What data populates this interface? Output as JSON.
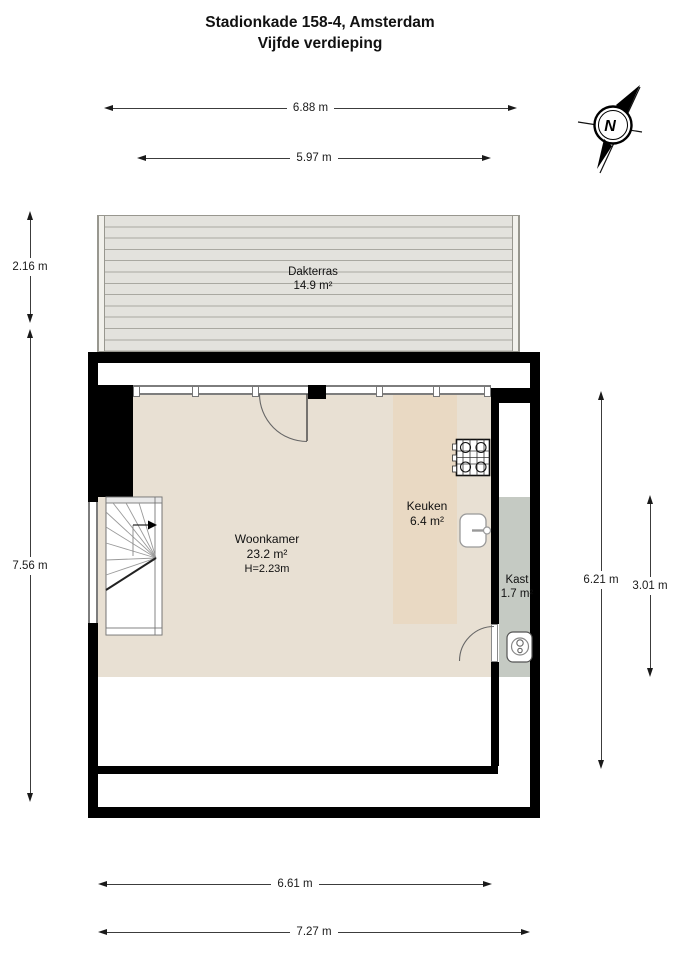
{
  "title": {
    "line1": "Stadionkade 158-4, Amsterdam",
    "line2": "Vijfde verdieping"
  },
  "compass": {
    "north_label": "N"
  },
  "rooms": {
    "dakterras": {
      "name": "Dakterras",
      "area": "14.9 m²"
    },
    "woonkamer": {
      "name": "Woonkamer",
      "area": "23.2 m²",
      "ceiling_height": "H=2.23m"
    },
    "keuken": {
      "name": "Keuken",
      "area": "6.4 m²"
    },
    "kast": {
      "name": "Kast",
      "area": "1.7 m²"
    }
  },
  "dimensions": {
    "top_outer": "6.88 m",
    "top_inner": "5.97 m",
    "left_terrace": "2.16 m",
    "left_main": "7.56 m",
    "right_main": "6.21 m",
    "right_kast": "3.01 m",
    "bottom_inner": "6.61 m",
    "bottom_outer": "7.27 m"
  },
  "icons": {
    "compass": "compass-rose-icon",
    "stairs": "stairs-icon",
    "stove": "stove-icon",
    "sink": "sink-icon",
    "boiler": "boiler-icon"
  },
  "colors": {
    "floor": "#e8e0d3",
    "kitchen_floor": "#e9d9c3",
    "closet_floor": "#c5cac3",
    "terrace_plank": "#e3e2dd",
    "terrace_line": "#a9a8a1",
    "wall": "#000000"
  }
}
